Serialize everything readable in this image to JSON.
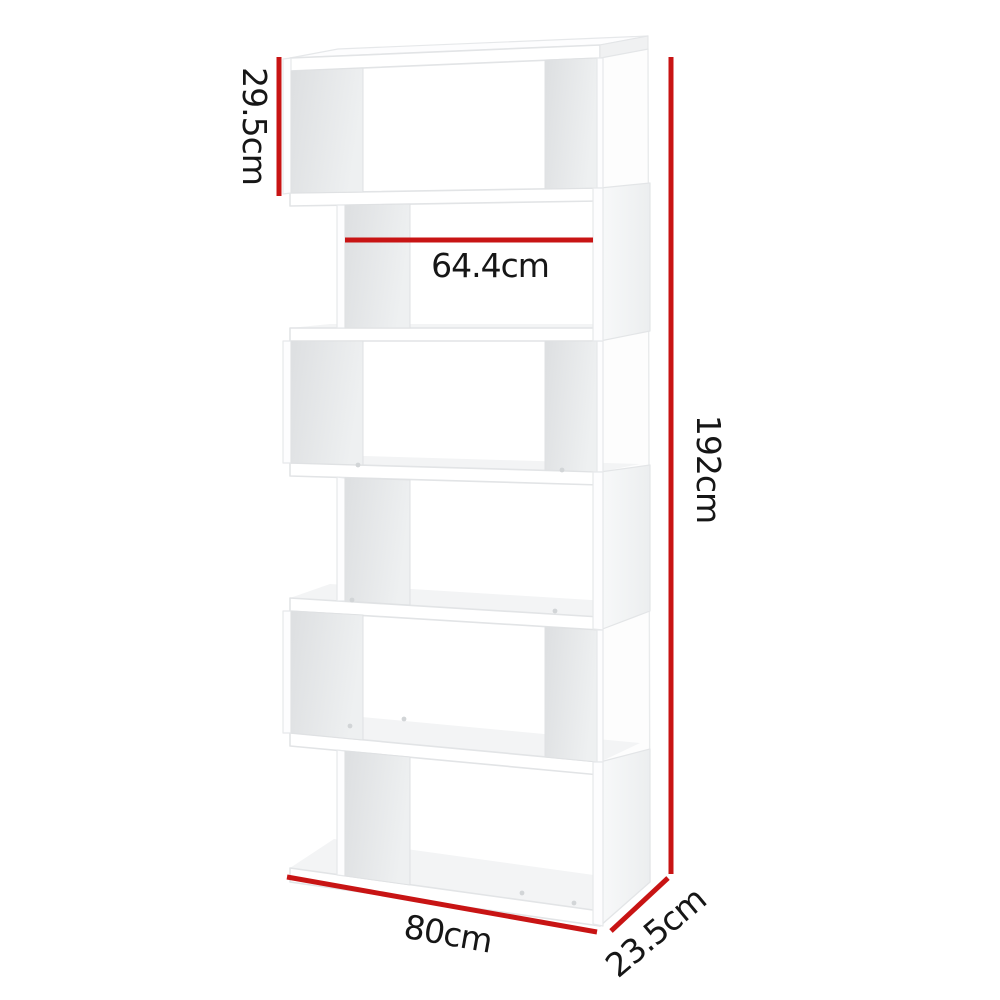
{
  "diagram": {
    "type": "product-dimension-diagram",
    "product": "6-tier S-shape zigzag display shelf",
    "background_color": "#ffffff",
    "shelf": {
      "tier_count": 6,
      "body_color": "#ffffff",
      "inner_panel_shade": "#e2e4e6"
    },
    "colors": {
      "dimension_line": "#c81414",
      "label_text": "#161616"
    },
    "dimensions": {
      "tier_height": {
        "label": "29.5cm",
        "orientation": "vertical",
        "position": "top-left"
      },
      "inner_width": {
        "label": "64.4cm",
        "orientation": "horizontal",
        "position": "second-tier"
      },
      "total_height": {
        "label": "192cm",
        "orientation": "vertical",
        "position": "right"
      },
      "width": {
        "label": "80cm",
        "orientation": "slanted",
        "position": "bottom"
      },
      "depth": {
        "label": "23.5cm",
        "orientation": "slanted",
        "position": "bottom-right"
      }
    }
  }
}
